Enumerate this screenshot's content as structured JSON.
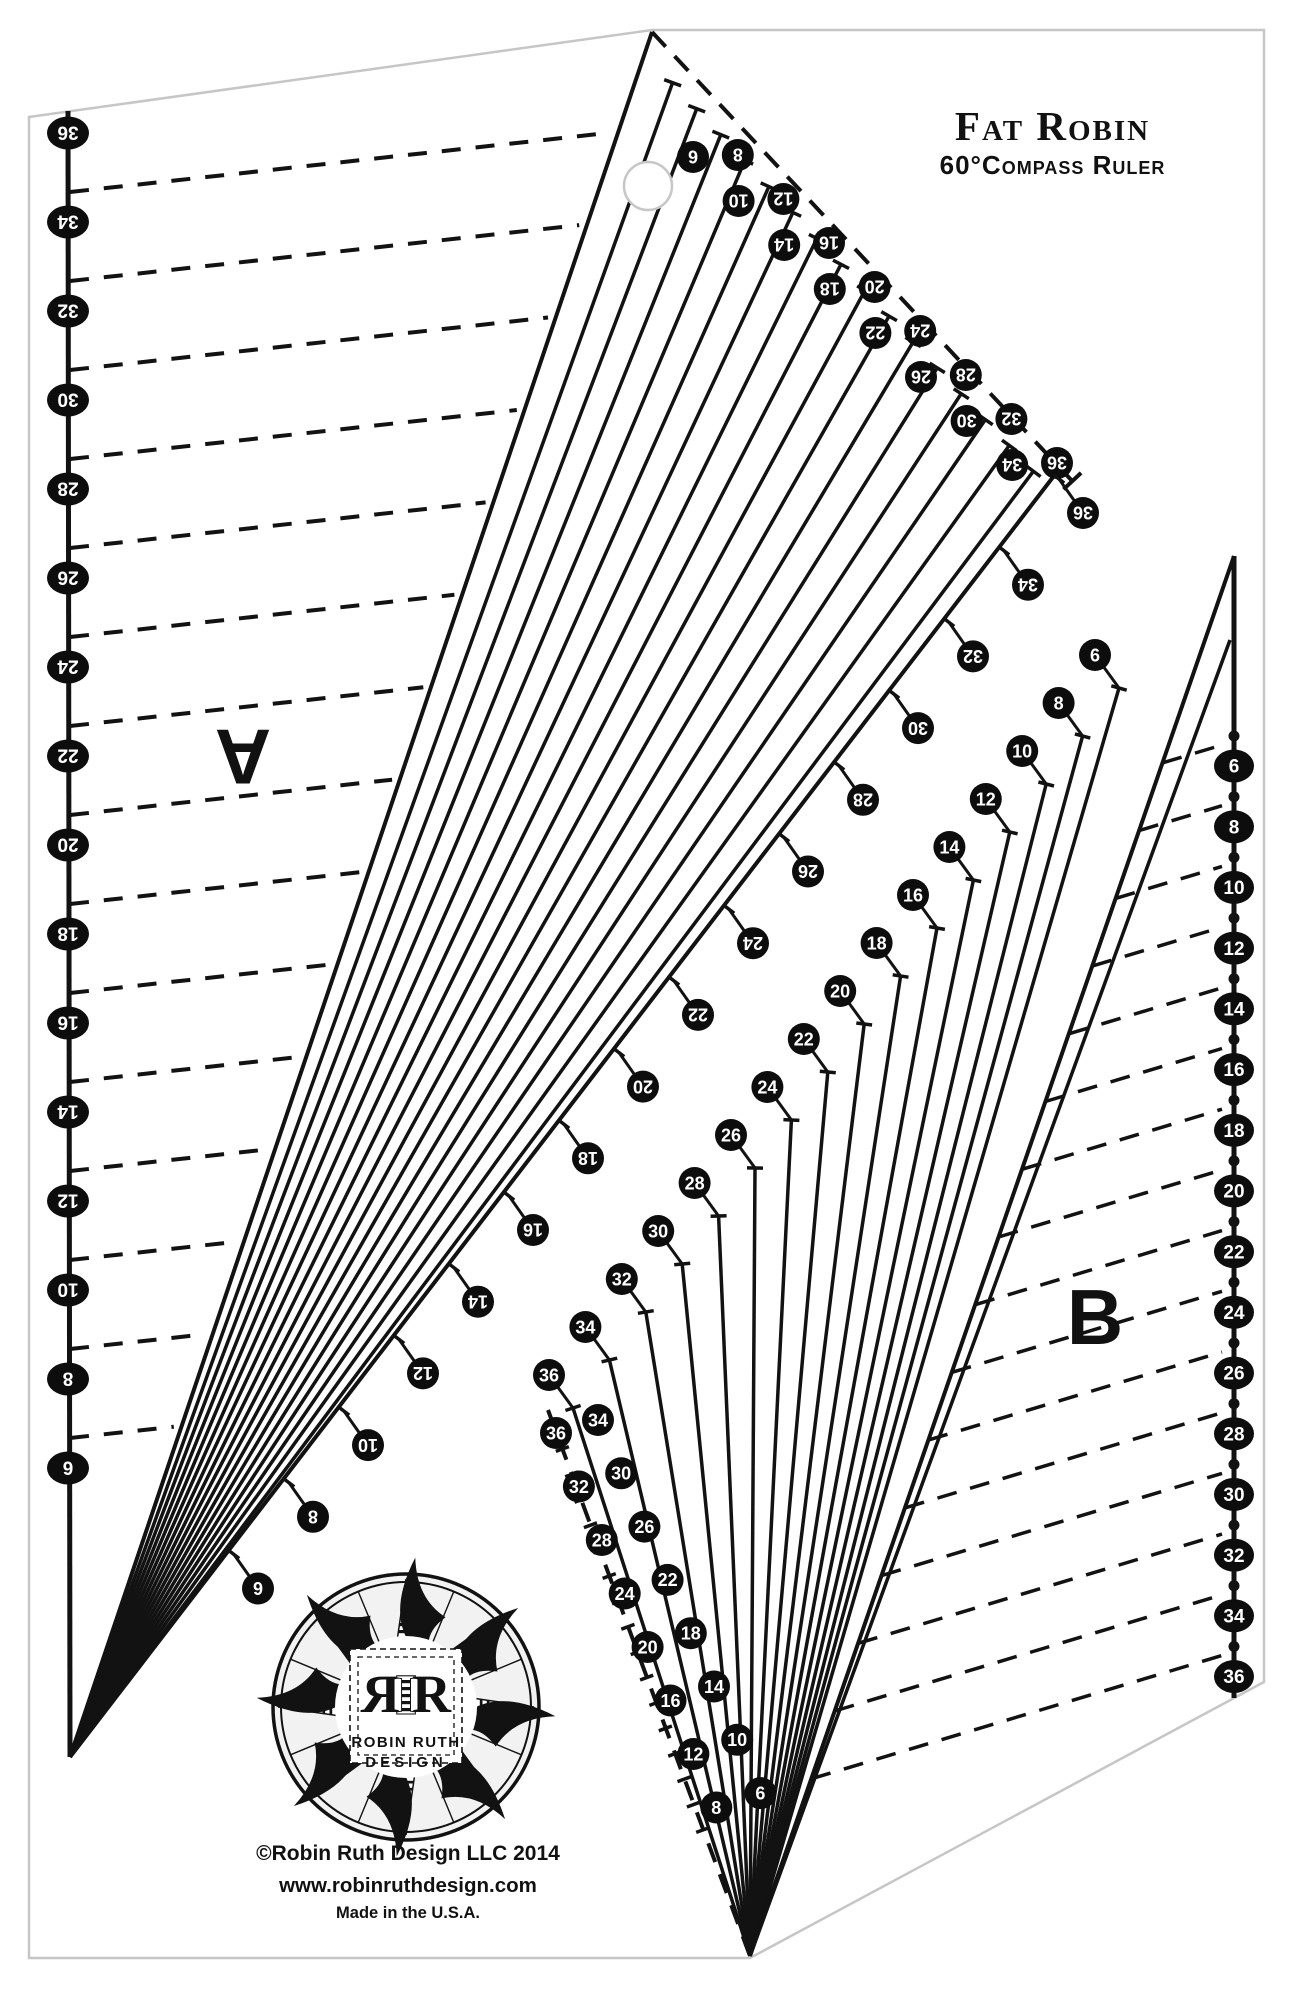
{
  "title": {
    "line1": "Fat Robin",
    "line2": "60°Compass Ruler"
  },
  "labels": {
    "blade_a": "A",
    "blade_b": "B"
  },
  "logo": {
    "monogram_left": "R",
    "monogram_mid": "I",
    "monogram_right": "R",
    "name_line1": "ROBIN RUTH",
    "name_line2": "DESIGN"
  },
  "footer": {
    "copyright": "©Robin Ruth Design LLC 2014",
    "website": "www.robinruthdesign.com",
    "made_in": "Made in the U.S.A."
  },
  "scales": {
    "left_edge": {
      "values": [
        36,
        34,
        32,
        30,
        28,
        26,
        24,
        22,
        20,
        18,
        16,
        14,
        12,
        10,
        8,
        6
      ],
      "rotated": true
    },
    "top_edge": {
      "values": [
        6,
        8,
        10,
        12,
        14,
        16,
        18,
        20,
        22,
        24,
        26,
        28,
        30,
        32,
        34,
        36
      ],
      "rotated": true
    },
    "inner_left": {
      "values": [
        36,
        34,
        32,
        30,
        28,
        26,
        24,
        22,
        20,
        18,
        16,
        14,
        12,
        10,
        8,
        6
      ],
      "rotated": true
    },
    "inner_right": {
      "values": [
        6,
        8,
        10,
        12,
        14,
        16,
        18,
        20,
        22,
        24,
        26,
        28,
        30,
        32,
        34,
        36
      ],
      "rotated": false
    },
    "bottom_edge": {
      "values": [
        36,
        34,
        32,
        30,
        28,
        26,
        24,
        22,
        20,
        18,
        16,
        14,
        12,
        10,
        8,
        6
      ],
      "rotated": false
    },
    "right_edge": {
      "values": [
        6,
        8,
        10,
        12,
        14,
        16,
        18,
        20,
        22,
        24,
        26,
        28,
        30,
        32,
        34,
        36
      ],
      "rotated": false
    }
  },
  "colors": {
    "ink": "#121212",
    "badge_bg": "#0d0d0d",
    "badge_text": "#ffffff",
    "outline": "#c6c6c6",
    "logo_fill": "#f2f2f2",
    "paper": "#ffffff"
  }
}
